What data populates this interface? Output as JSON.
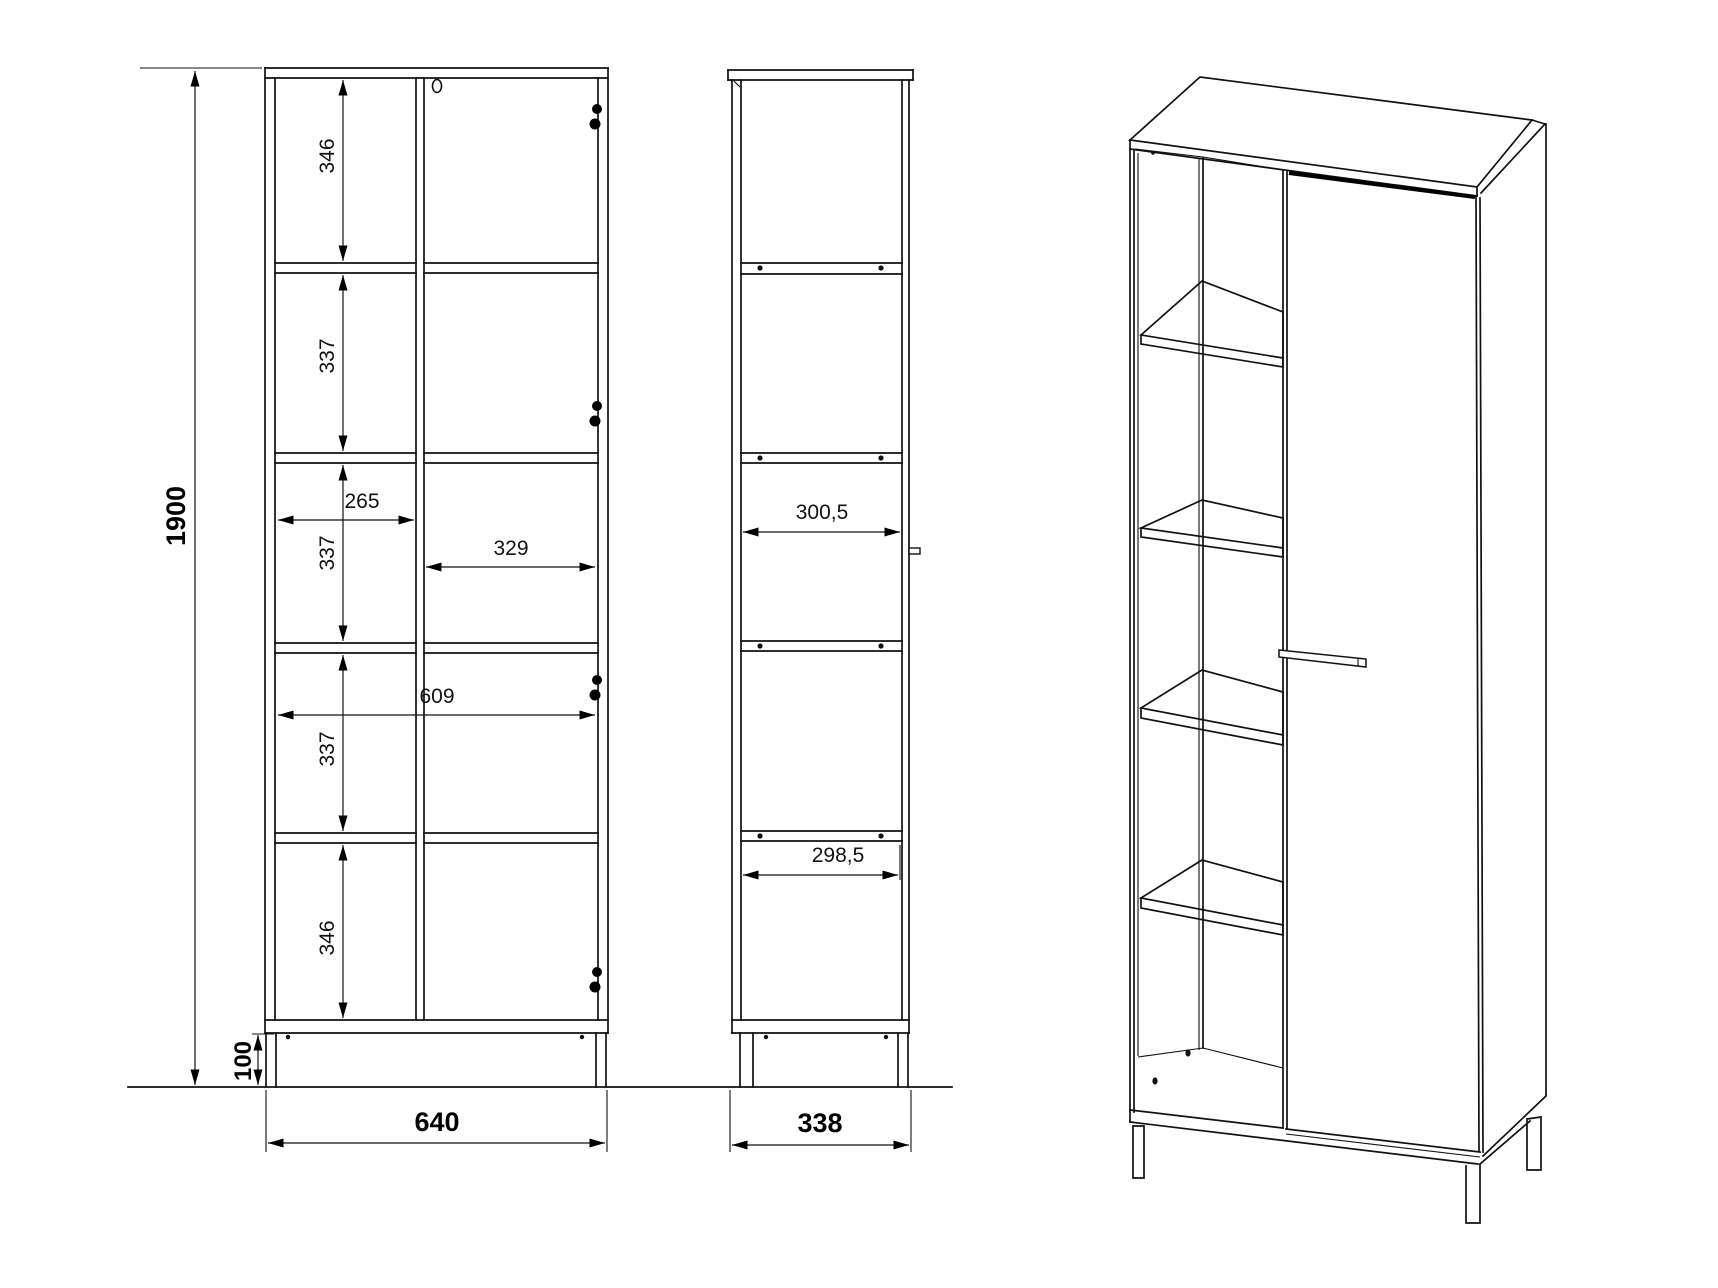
{
  "drawing": {
    "front_view": {
      "overall_height": "1900",
      "section_heights": [
        "346",
        "337",
        "337",
        "337",
        "346"
      ],
      "left_compartment_width": "265",
      "right_compartment_width": "329",
      "internal_width": "609",
      "leg_height": "100",
      "overall_width": "640"
    },
    "side_view": {
      "internal_depth_upper": "300,5",
      "internal_depth_lower": "298,5",
      "overall_depth": "338"
    }
  }
}
